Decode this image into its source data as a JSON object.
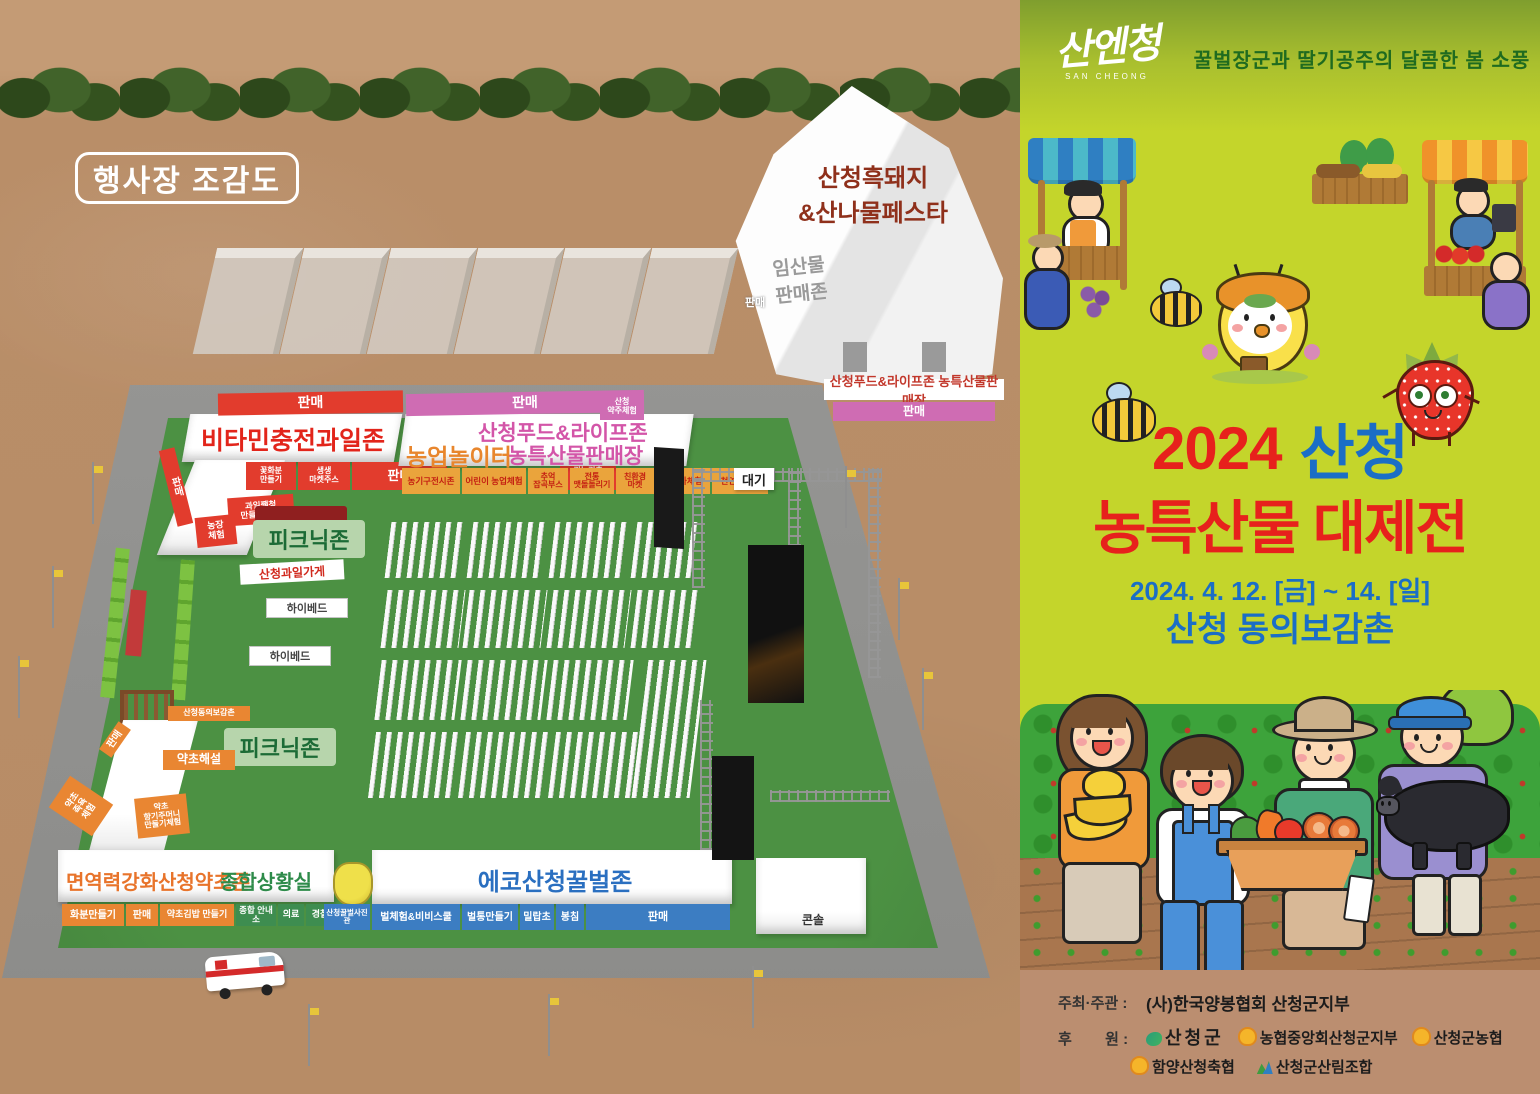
{
  "map": {
    "badge": "행사장 조감도",
    "pig_tent": {
      "title": "산청흑돼지\n&산나물페스타",
      "forest": "임산물\n판매존",
      "sale": "판매",
      "banner": "산청푸드&라이프존 농특산물판매장",
      "banner_sale": "판매"
    },
    "fruit": {
      "sale_top": "판매",
      "title": "비타민충전과일존",
      "sale_side": "판매",
      "b1": "꽃화분\n만들기",
      "b2": "생생\n마켓주스",
      "b3": "판매",
      "b4": "귀농귀촌\n상담소",
      "jam": "과일쨈청\n만들기 체험",
      "farm": "농장\n체험",
      "shop": "산청과일가게"
    },
    "food": {
      "sale_top": "판매",
      "corner": "산청\n약주체험",
      "title1": "산청푸드&라이프존",
      "title2": "농특산물판매장",
      "play": "농업놀이터",
      "b1": "농기구전시존",
      "b2": "어린이 농업체험",
      "b3": "추억\n잡곡부스",
      "b4": "전통\n맷돌돌리기",
      "b5": "친환경\n마켓",
      "b6": "전통차체험",
      "b7": "천연화장품"
    },
    "herb": {
      "donguibogam": "산청동의보감촌",
      "sale": "판매",
      "b1": "약초해설",
      "b2": "약초\n족욕\n체험",
      "b3": "약초\n향기주머니\n만들기체험"
    },
    "picnic1": "피크닉존",
    "picnic2": "피크닉존",
    "highbed1": "하이베드",
    "highbed2": "하이베드",
    "immune": {
      "title1": "면역력강화산청약초존",
      "title2": "종합상황실",
      "b1": "화분만들기",
      "b2": "판매",
      "b3": "약초김밥 만들기",
      "b4": "종합 안내소",
      "b5": "의료",
      "b6": "경찰"
    },
    "bee": {
      "title": "에코산청꿀벌존",
      "photo": "산청꿀벌사진관",
      "b1": "벌체험&비비스쿨",
      "b2": "벌통만들기",
      "b3": "밀랍초",
      "b4": "봉침",
      "b5": "판매"
    },
    "stage": {
      "wait": "대기",
      "console": "콘솔"
    }
  },
  "poster": {
    "logo": "산엔청",
    "logo_sub": "SAN CHEONG",
    "tagline": "꿀벌장군과 딸기공주의 달콤한 봄 소풍",
    "year": "2024",
    "region": "산청",
    "title2": "농특산물 대제전",
    "date": "2024. 4. 12. [금] ~ 14. [일]",
    "venue": "산청  동의보감촌",
    "host_label": "주최·주관 :",
    "host": "(사)한국양봉협회 산청군지부",
    "sponsor_label": "후        원 :",
    "s1": "산청군",
    "s2": "농협중앙회산청군지부",
    "s3": "산청군농협",
    "s4": "함양산청축협",
    "s5": "산청군산림조합"
  },
  "colors": {
    "poster_bg": "#c4d52b",
    "title_red": "#e7211c",
    "title_blue": "#1b6ec6",
    "zone_red": "#e23c2d",
    "zone_pink": "#cf6cb3",
    "zone_orange": "#e98632",
    "zone_green": "#3e8d50",
    "zone_blue": "#3c7dc2",
    "label_yellow": "#eaa43c",
    "dirt": "#b98e68",
    "grass": "#4c9143"
  }
}
